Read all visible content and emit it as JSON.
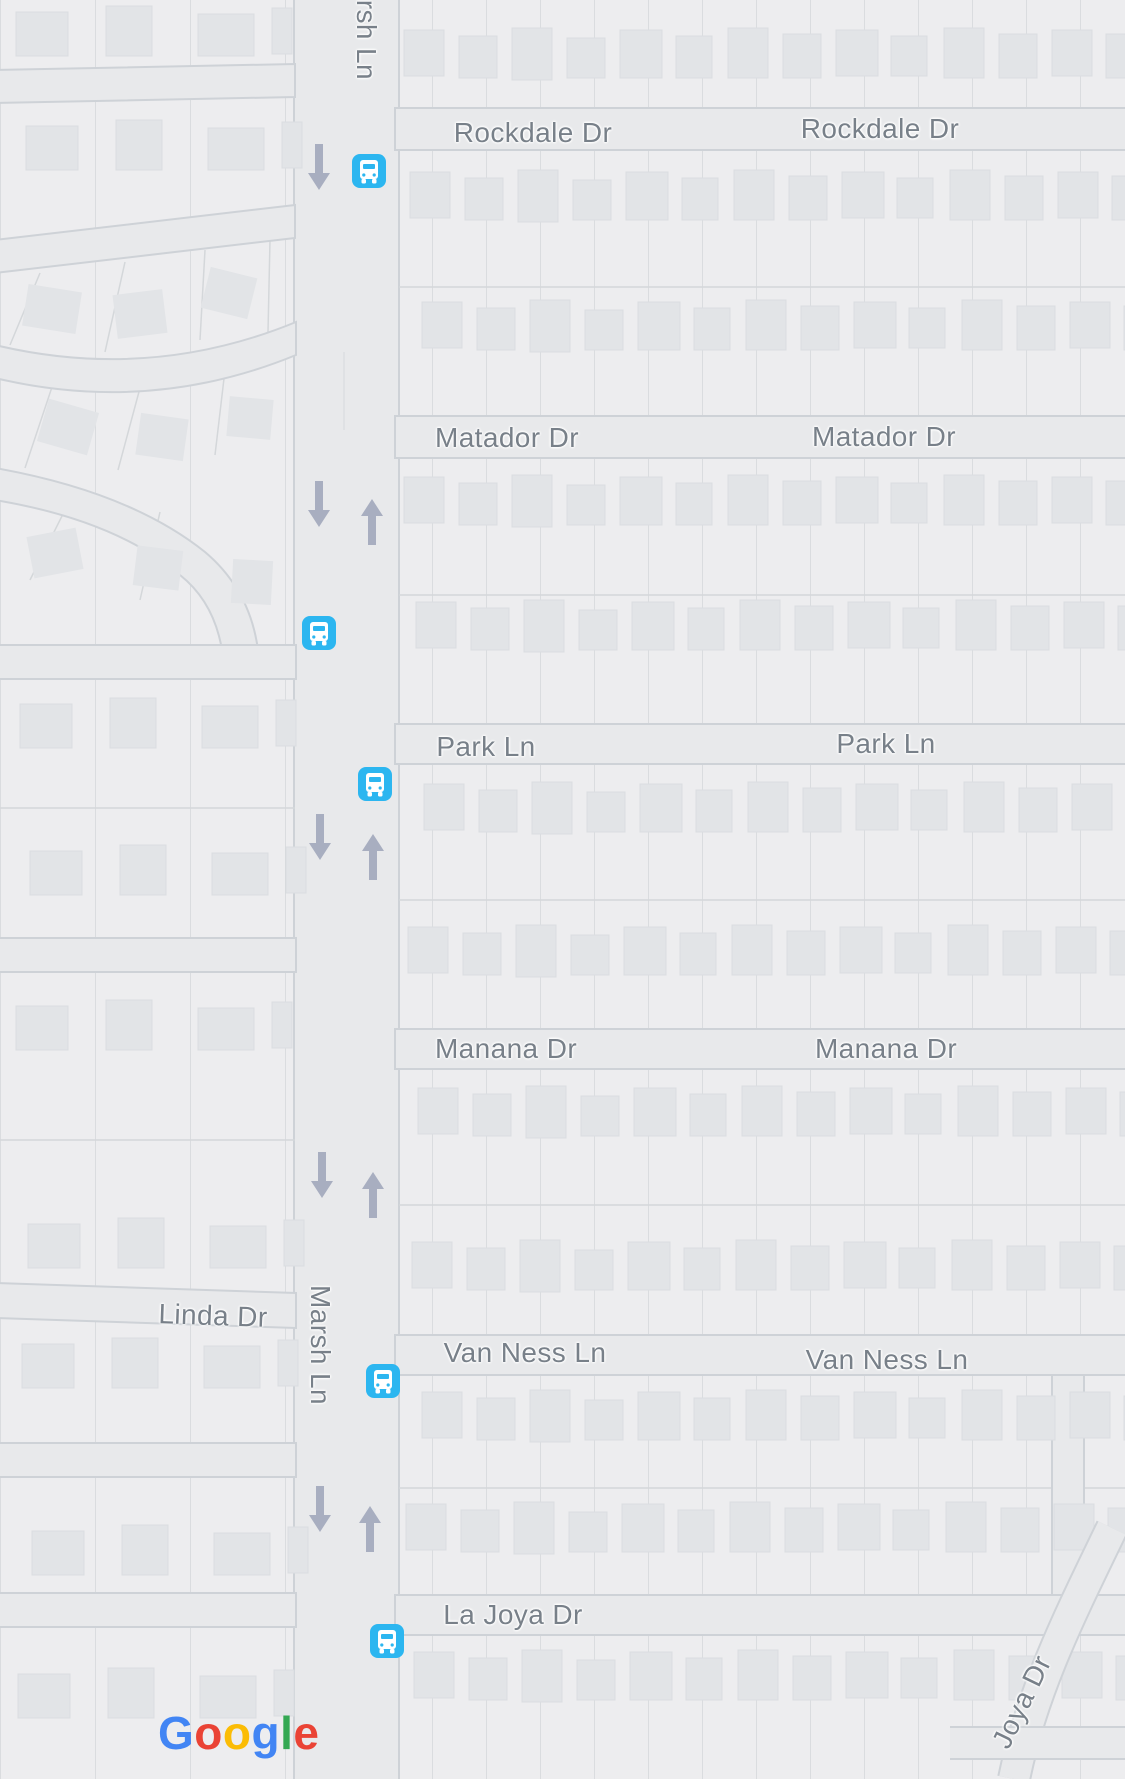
{
  "map_type": "street-map",
  "streets": {
    "marsh_ln": "Marsh Ln",
    "rockdale_dr": "Rockdale Dr",
    "matador_dr": "Matador Dr",
    "park_ln": "Park Ln",
    "manana_dr": "Manana Dr",
    "van_ness_ln": "Van Ness Ln",
    "la_joya_dr": "La Joya Dr",
    "linda_dr": "Linda Dr",
    "joya_dr": "Joya Dr"
  },
  "transit": {
    "bus_stop_icon": "bus-stop-icon",
    "stop_count": 5
  },
  "road_markings": {
    "one_way_down_count": 5,
    "one_way_up_count": 4
  },
  "google_logo": {
    "text": "Google",
    "letters": [
      {
        "ch": "G",
        "color": "#4285F4"
      },
      {
        "ch": "o",
        "color": "#EA4335"
      },
      {
        "ch": "o",
        "color": "#FBBC05"
      },
      {
        "ch": "g",
        "color": "#4285F4"
      },
      {
        "ch": "l",
        "color": "#34A853"
      },
      {
        "ch": "e",
        "color": "#EA4335"
      }
    ]
  },
  "colors": {
    "road": "#e8e9eb",
    "block": "#ededef",
    "block_border": "#ced2d7",
    "lot_line": "#d4d7da",
    "building": "#e2e4e7",
    "label_text": "#788089",
    "bus_icon": "#2cb6f0",
    "one_way_arrow": "#a8aec0"
  }
}
